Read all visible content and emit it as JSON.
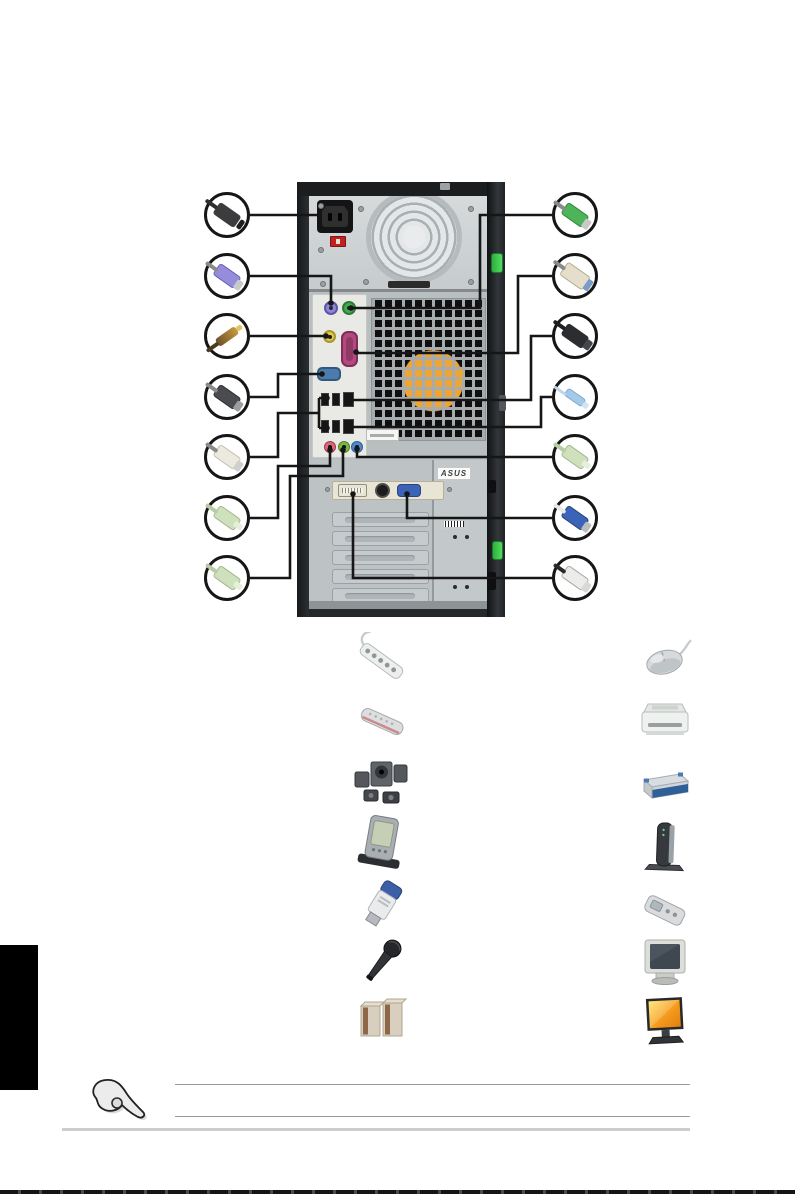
{
  "page": {
    "background_color": "#ffffff",
    "side_tab_color": "#000000",
    "bottom_edge_color": "#141414",
    "rule_color": "#9b9b9b"
  },
  "rear_panel_diagram": {
    "tower": {
      "asus_sticker_text": "ASUS",
      "colors": {
        "case_metal": "#bdc2c4",
        "frame_black": "#1b1d1f",
        "io_shield": "#e9eae6",
        "clip_green": "#4fdd5f",
        "cpu_fan_orange": "#f0a432",
        "psu_metal": "#d6dadb"
      },
      "ports": [
        {
          "name": "ac-power-inlet",
          "color": "#141414"
        },
        {
          "name": "voltage-selector-switch",
          "color": "#bf2020"
        },
        {
          "name": "psu-fan-grille",
          "color": "#e4e7e8"
        },
        {
          "name": "ps2-keyboard-port",
          "color": "#8f86d8"
        },
        {
          "name": "ps2-mouse-port",
          "color": "#46a94f"
        },
        {
          "name": "spdif-coaxial-out",
          "color": "#e0cc4a"
        },
        {
          "name": "parallel-port",
          "color": "#b3497e"
        },
        {
          "name": "serial-port",
          "color": "#4a7dad"
        },
        {
          "name": "usb-ports-top-row",
          "color": "#161616"
        },
        {
          "name": "ieee1394-port",
          "color": "#161616"
        },
        {
          "name": "usb-ports-bottom-row",
          "color": "#161616"
        },
        {
          "name": "lan-port",
          "color": "#161616"
        },
        {
          "name": "microphone-jack",
          "color": "#d86878"
        },
        {
          "name": "line-out-jack",
          "color": "#7ab648"
        },
        {
          "name": "line-in-jack",
          "color": "#4f87c8"
        },
        {
          "name": "dvi-port",
          "color": "#f4f3ea"
        },
        {
          "name": "svideo-port",
          "color": "#1c1c1c"
        },
        {
          "name": "vga-port",
          "color": "#3b63b8"
        }
      ]
    },
    "callout_connectors": {
      "left": [
        "power-cord-plug",
        "ps2-keyboard-plug",
        "spdif-coaxial-plug",
        "serial-db9-plug",
        "usb-type-a-plug",
        "audio-mini-plug",
        "audio-mini-plug"
      ],
      "right": [
        "ps2-mouse-plug",
        "parallel-db25-plug",
        "ieee1394-plug",
        "lan-cable-plug",
        "audio-mini-plug",
        "vga-plug",
        "dvi-plug"
      ]
    }
  },
  "peripherals": {
    "left_column": [
      "power-strip",
      "remote-control",
      "surround-speaker-set",
      "pda",
      "usb-flash-drive",
      "microphone",
      "speaker-pair"
    ],
    "right_column": [
      "mouse",
      "printer",
      "external-drive",
      "modem",
      "mp3-player",
      "crt-monitor",
      "lcd-monitor"
    ]
  },
  "note": {
    "icon": "pointing-hand-icon",
    "rule_count": 2
  }
}
